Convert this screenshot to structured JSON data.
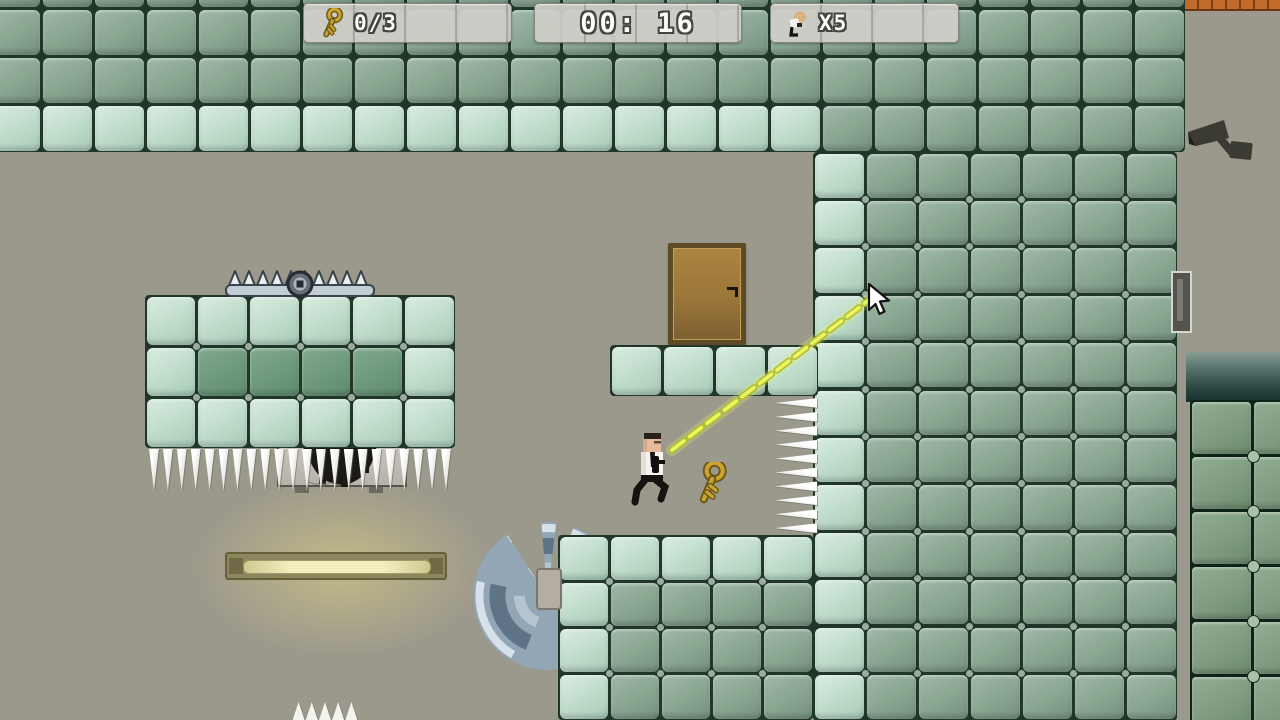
{
  "window": {
    "width": 1280,
    "height": 720
  },
  "hud": {
    "keys_panel": {
      "label": "0/3",
      "icon": "key-icon"
    },
    "timer_panel": {
      "label": "00: 16"
    },
    "lives_panel": {
      "label": "X5",
      "icon": "agent-icon"
    }
  },
  "colors": {
    "background": "#9b988c",
    "tile_gap": "#203629",
    "tile_gap_dark": "#0d2318",
    "tile_medium": "#8aa792",
    "tile_medium_hi": "#9fb9a8",
    "tile_medium_lo": "#75927f",
    "tile_light": "#c0ddcc",
    "tile_light_hi": "#d9ece0",
    "tile_light_lo": "#a8cab7",
    "tile_dark": "#6f9a7e",
    "tile_dark_hi": "#80aa8e",
    "tile_dark_lo": "#5e8a6d",
    "tile_deep": "#7f9c81",
    "tile_deep_hi": "#90ad91",
    "tile_deep_lo": "#6c8a6e",
    "laser": "#ecf75f",
    "laser_outline": "#b3bf37",
    "key_gold": "#cda42e",
    "key_gold_dark": "#6e591d",
    "door_wood": "#a9833f",
    "door_frame": "#5e4a24",
    "metal_light": "#d6e1ea",
    "metal_mid": "#93a6b5",
    "metal_dark": "#5e7486",
    "camera_body": "#3b3b34",
    "brick": "#c06a2c",
    "brick_line": "#7e3f16",
    "glow": "rgba(225,213,130,0.55)",
    "hud_panel": "rgba(206,206,199,0.95)",
    "hud_text_outline": "#45453e"
  },
  "regions": [
    {
      "name": "top-wall",
      "x": -11,
      "y": -40,
      "tw": 52,
      "th": 48,
      "cols": 23,
      "rows": 4,
      "dots": false,
      "rows_spec": [
        "mmmmmmmmmmmmmmmmmmmmmmm",
        "mmmmmmmmmmmmmmmmmmmmmmm",
        "mmmmmmmmmmmmmmmmmmmmmmm",
        "llllllllllllllllmmmmmmm"
      ]
    },
    {
      "name": "right-wall",
      "x": 813,
      "y": 152,
      "tw": 52,
      "th": 47.4,
      "cols": 7,
      "rows": 12,
      "dots": true,
      "rows_spec": [
        "lmmmmmm",
        "lmmmmmm",
        "lmmmmmm",
        "lmmmmmm",
        "lmmmmmm",
        "lmmmmmm",
        "lmmmmmm",
        "lmmmmmm",
        "lmmmmmm",
        "lmmmmmm",
        "lmmmmmm",
        "lmmmmmm"
      ]
    },
    {
      "name": "door-ledge",
      "x": 610,
      "y": 345,
      "tw": 52,
      "th": 51,
      "cols": 4,
      "rows": 1,
      "dots": false,
      "rows_spec": [
        "llll"
      ]
    },
    {
      "name": "left-platform",
      "x": 145,
      "y": 295,
      "tw": 51.7,
      "th": 51,
      "cols": 6,
      "rows": 3,
      "dots": true,
      "rows_spec": [
        "llllll",
        "lddddl",
        "llllll"
      ]
    },
    {
      "name": "bottom-platform",
      "x": 558,
      "y": 535,
      "tw": 51,
      "th": 46.3,
      "cols": 5,
      "rows": 4,
      "dots": true,
      "rows_spec": [
        "lllll",
        "lmmmm",
        "lmmmm",
        "lmmmm"
      ]
    },
    {
      "name": "dark-wall-bottom-right",
      "x": 1190,
      "y": 400,
      "tw": 62,
      "th": 55,
      "cols": 2,
      "rows": 6,
      "dots": true,
      "gap_dark": true,
      "rows_spec": [
        "bb",
        "bb",
        "bb",
        "bb",
        "bb",
        "bb"
      ]
    }
  ],
  "entities": [
    {
      "type": "glow",
      "name": "lamp-glow",
      "x": 146,
      "y": 450,
      "w": 390,
      "h": 235,
      "z": 1
    },
    {
      "type": "saw",
      "name": "saw-blade",
      "x": 465,
      "y": 512,
      "w": 164,
      "h": 164,
      "z": 2
    },
    {
      "type": "band",
      "name": "pipe-gradient",
      "x": 1186,
      "y": 352,
      "w": 94,
      "h": 50,
      "z": 2
    },
    {
      "type": "bricks",
      "name": "brick-strip",
      "x": 1171,
      "y": 0,
      "w": 109,
      "h": 9,
      "z": 2
    },
    {
      "type": "camera",
      "name": "security-camera",
      "x": 1186,
      "y": 114,
      "w": 68,
      "h": 52,
      "z": 2
    },
    {
      "type": "door",
      "name": "exit-door",
      "x": 668,
      "y": 243,
      "w": 78,
      "h": 102,
      "z": 2
    },
    {
      "type": "machine",
      "name": "incinerator-box",
      "x": 277,
      "y": 437,
      "w": 130,
      "h": 56,
      "z": 2
    },
    {
      "type": "light",
      "name": "fluorescent-lamp",
      "x": 225,
      "y": 552,
      "w": 222,
      "h": 28,
      "z": 2
    },
    {
      "type": "vent",
      "name": "wall-vent",
      "x": 1171,
      "y": 271,
      "w": 21,
      "h": 62,
      "z": 4
    },
    {
      "type": "bracket",
      "name": "saw-mount",
      "x": 536,
      "y": 568,
      "w": 26,
      "h": 42,
      "z": 4
    },
    {
      "type": "trap",
      "name": "bear-trap",
      "x": 224,
      "y": 266,
      "w": 152,
      "h": 32,
      "z": 4
    },
    {
      "type": "spikes",
      "name": "hanging-spikes",
      "dir": "down",
      "x": 147,
      "y": 449,
      "len": 306,
      "count": 22,
      "size": 42,
      "z": 4
    },
    {
      "type": "spikes",
      "name": "wall-spikes",
      "dir": "left",
      "x": 775,
      "y": 396,
      "len": 139,
      "count": 10,
      "size": 42,
      "z": 4
    },
    {
      "type": "spikes",
      "name": "floor-spikes",
      "dir": "up",
      "x": 292,
      "y": 702,
      "len": 66,
      "count": 5,
      "size": 18,
      "z": 4
    },
    {
      "type": "character",
      "name": "player-character",
      "x": 628,
      "y": 432,
      "w": 44,
      "h": 74,
      "z": 4
    },
    {
      "type": "key",
      "name": "key-pickup",
      "x": 690,
      "y": 462,
      "w": 42,
      "h": 42,
      "z": 4
    },
    {
      "type": "laser",
      "name": "aim-laser",
      "x1": 672,
      "y1": 450,
      "x2": 869,
      "y2": 300,
      "z": 6
    },
    {
      "type": "cursor",
      "name": "mouse-cursor",
      "x": 866,
      "y": 283,
      "w": 26,
      "h": 34,
      "z": 9
    }
  ]
}
